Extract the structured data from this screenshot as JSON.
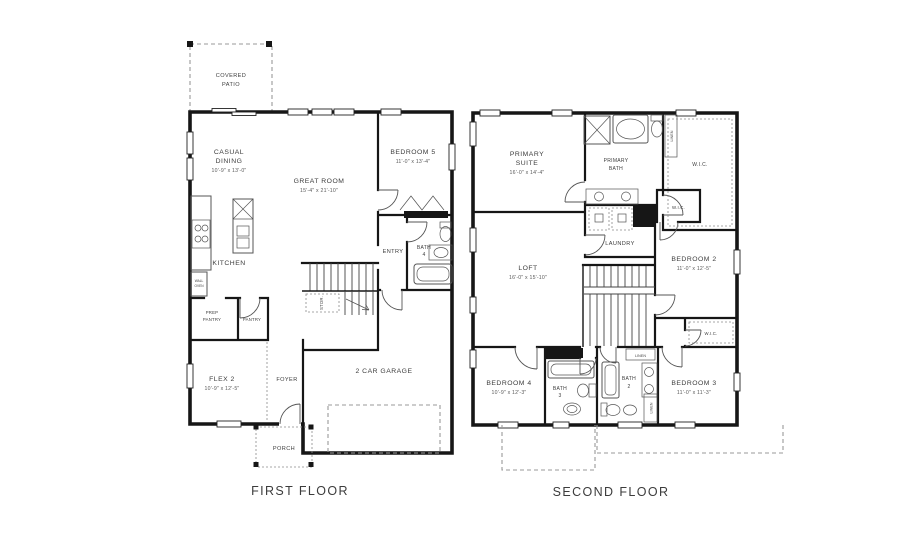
{
  "captions": {
    "first": "FIRST FLOOR",
    "second": "SECOND FLOOR"
  },
  "first_floor": {
    "covered_patio_1": "COVERED",
    "covered_patio_2": "PATIO",
    "casual_dining_1": "CASUAL",
    "casual_dining_2": "DINING",
    "casual_dining_dims": "10'-9\" x 13'-0\"",
    "great_room": "GREAT ROOM",
    "great_room_dims": "15'-4\" x 21'-10\"",
    "bedroom5": "BEDROOM 5",
    "bedroom5_dims": "11'-0\" x 13'-4\"",
    "kitchen": "KITCHEN",
    "wall_oven_1": "WALL",
    "wall_oven_2": "OVEN",
    "prep_pantry_1": "PREP",
    "prep_pantry_2": "PANTRY",
    "pantry": "PANTRY",
    "entry": "ENTRY",
    "bath4_1": "BATH",
    "bath4_2": "4",
    "stor": "STOR.",
    "flex2": "FLEX 2",
    "flex2_dims": "10'-9\" x 12'-5\"",
    "foyer": "FOYER",
    "garage": "2 CAR GARAGE",
    "porch": "PORCH"
  },
  "second_floor": {
    "primary_suite_1": "PRIMARY",
    "primary_suite_2": "SUITE",
    "primary_suite_dims": "16'-0\" x 14'-4\"",
    "primary_bath_1": "PRIMARY",
    "primary_bath_2": "BATH",
    "wic_primary": "W.I.C.",
    "linen_bath": "LINEN",
    "laundry": "LAUNDRY",
    "wic_hall": "W.I.C.",
    "bedroom2": "BEDROOM 2",
    "bedroom2_dims": "11'-0\" x 12'-5\"",
    "loft": "LOFT",
    "loft_dims": "16'-0\" x 15'-10\"",
    "wic_bedroom3": "W.I.C.",
    "bedroom4": "BEDROOM 4",
    "bedroom4_dims": "10'-9\" x 12'-3\"",
    "bath3_1": "BATH",
    "bath3_2": "3",
    "bath2_1": "BATH",
    "bath2_2": "2",
    "bedroom3": "BEDROOM 3",
    "bedroom3_dims": "11'-0\" x 11'-3\"",
    "linen_hall": "LINEN",
    "linen_bath2": "LINEN"
  }
}
